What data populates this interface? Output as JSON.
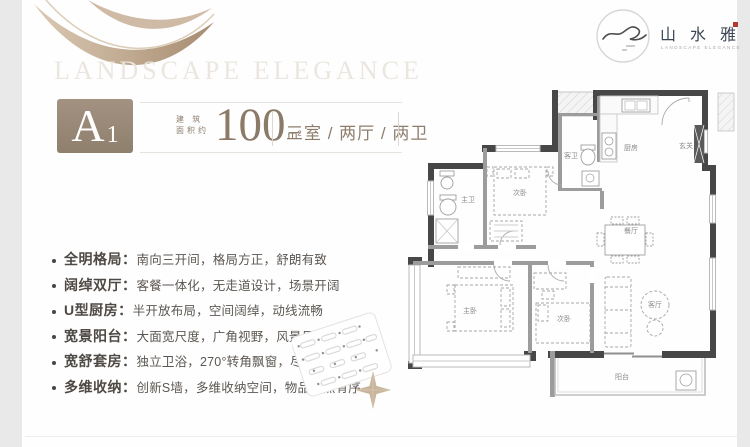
{
  "page": {
    "outer_bg": "#e9e9e9",
    "card_bg": "#fefefe"
  },
  "hero": {
    "watermark": "LANDSCAPE ELEGANCE"
  },
  "logo": {
    "cn": "山 水 雅 境",
    "en": "LANDSCAPE ELEGANCE",
    "seal_color": "#b5382c"
  },
  "header": {
    "unit_letter": "A",
    "unit_digit": "1",
    "area_label_top": "建 筑",
    "area_label_bottom": "面积约",
    "area_value": "100",
    "area_unit": "m²",
    "layout_text": "三室 / 两厅 / 两卫",
    "badge_color": "#98887a",
    "accent_color": "#8c7a69"
  },
  "features": [
    {
      "title": "全明格局：",
      "desc": "南向三开间，格局方正，舒朗有致"
    },
    {
      "title": "阔绰双厅：",
      "desc": "客餐一体化，无走道设计，场景开阔"
    },
    {
      "title": "U型厨房：",
      "desc": "半开放布局，空间阔绰，动线流畅"
    },
    {
      "title": "宽景阳台：",
      "desc": "大面宽尺度，广角视野，风景尽悦"
    },
    {
      "title": "宽舒套房：",
      "desc": "独立卫浴，270°转角飘窗，尽显尊崇"
    },
    {
      "title": "多维收纳：",
      "desc": "创新S墙，多维收纳空间，物品井然有序"
    }
  ],
  "floorplan": {
    "labels": {
      "master_bath": "主卫",
      "bedroom_top": "次卧",
      "guest_bath": "客卫",
      "kitchen": "厨房",
      "foyer": "玄关",
      "dining": "餐厅",
      "master_bedroom": "主卧",
      "bedroom_bottom": "次卧",
      "living": "客厅",
      "balcony": "阳台"
    }
  }
}
